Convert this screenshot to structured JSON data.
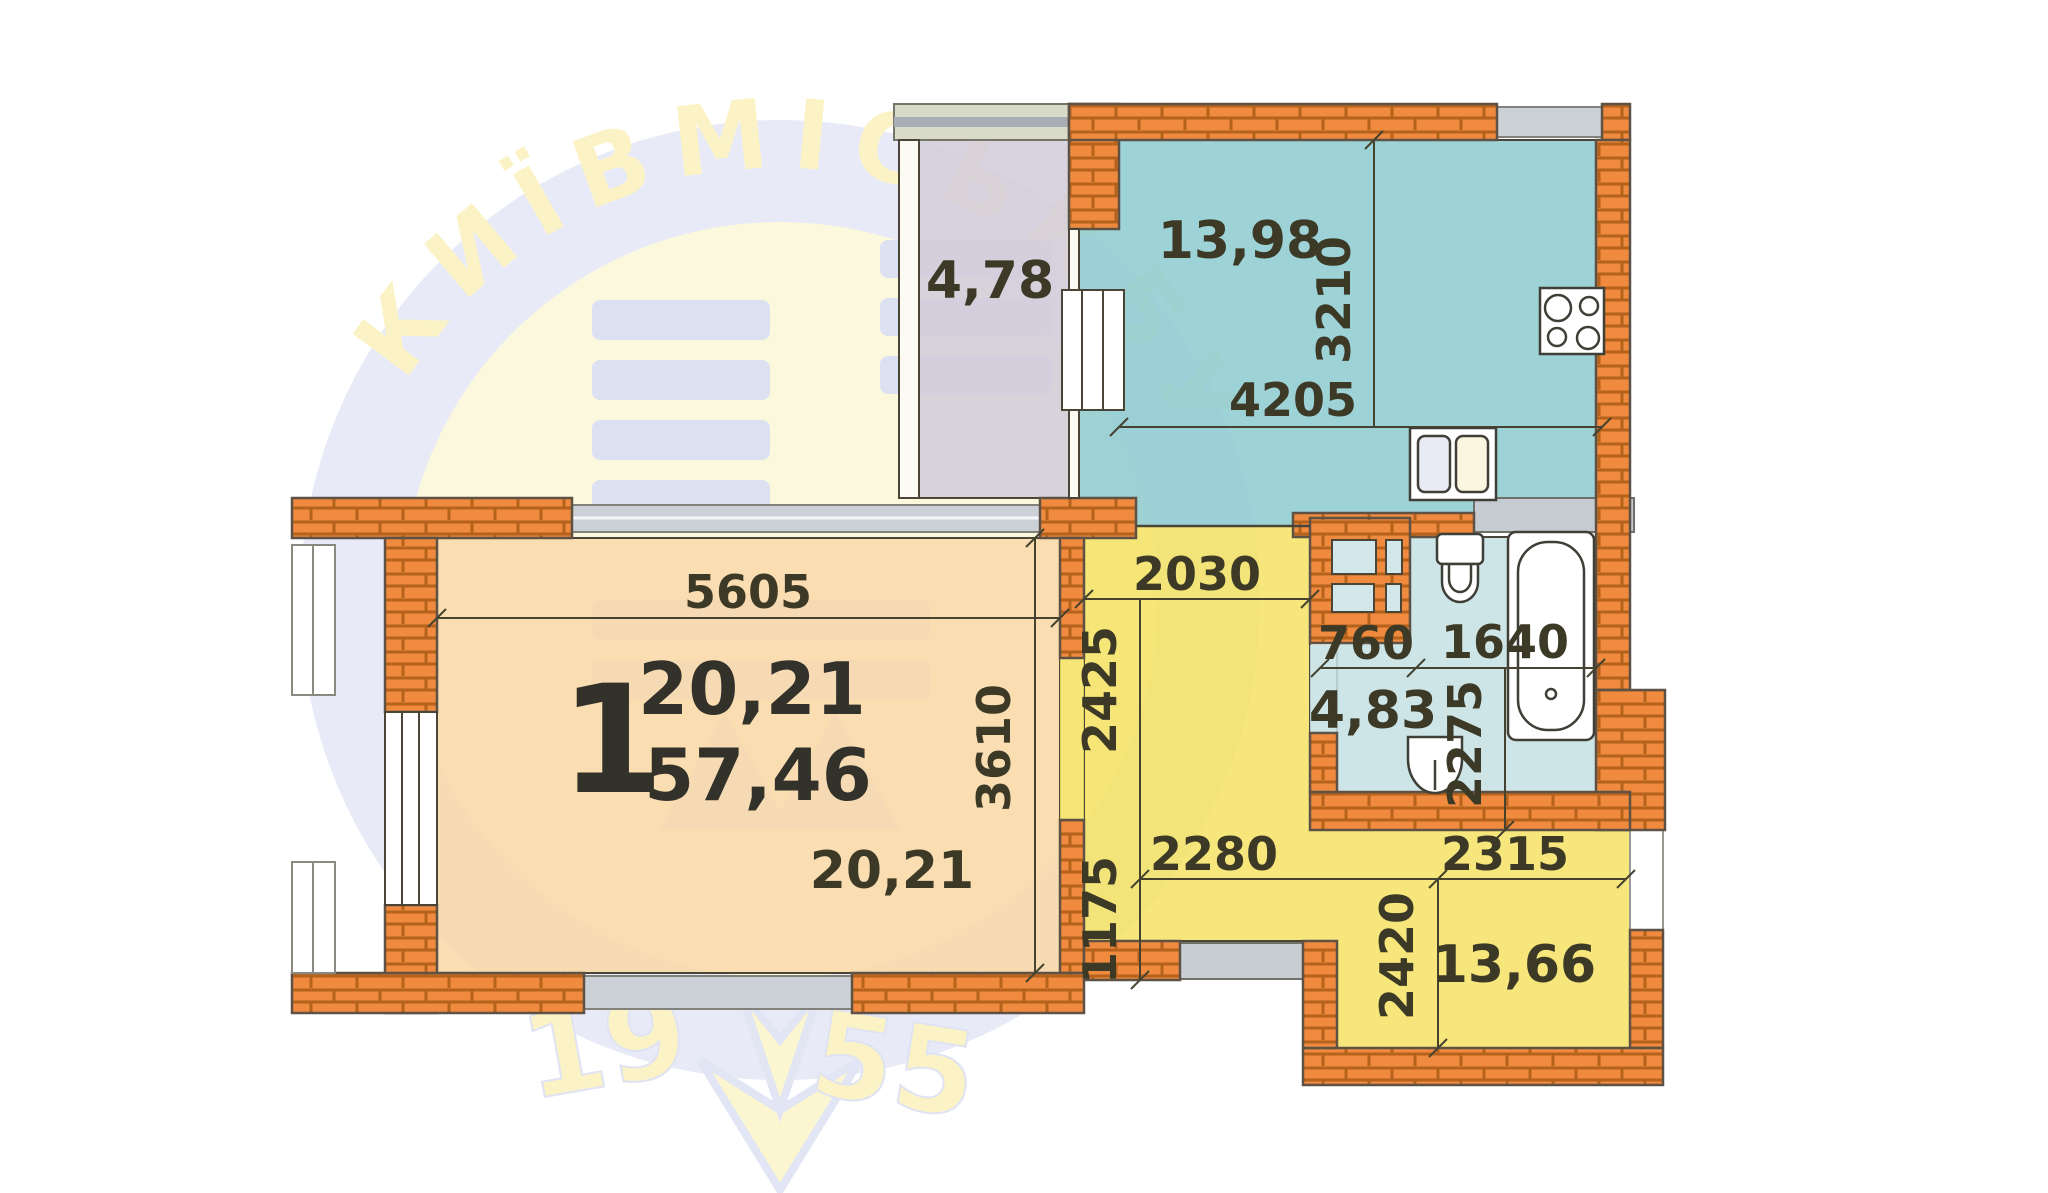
{
  "plan": {
    "apartment_number": "1",
    "living": {
      "area": "20,21",
      "total_area": "57,46",
      "area_bottom": "20,21",
      "dim_top": "5605",
      "dim_right": "3610"
    },
    "balcony": {
      "area": "4,78"
    },
    "kitchen": {
      "area": "13,98",
      "dim_width": "4205",
      "dim_height": "3210"
    },
    "hallway": {
      "dim_width": "2030",
      "dim_height": "2425",
      "dim_lower": "1175",
      "dim_bottom": "2280"
    },
    "bathroom": {
      "area": "4,83",
      "dim_left": "760",
      "dim_right": "1640",
      "dim_height": "2275"
    },
    "room_bottom": {
      "area": "13,66",
      "dim_top": "2315",
      "dim_height": "2420"
    },
    "watermark": {
      "ring_text": "КИЇВМІСЬКБУД",
      "year_left": "19",
      "year_right": "55"
    },
    "colors": {
      "brick": "#ef8a3e",
      "brick_mortar": "#b5621d",
      "living": "#f9d9a9",
      "balcony": "#d2cdd9",
      "kitchen": "#8fcbd1",
      "hallway": "#f5e267",
      "bathroom": "#c6e1e3",
      "window_gray": "#ccd1d8",
      "text": "#3c3a26"
    }
  }
}
